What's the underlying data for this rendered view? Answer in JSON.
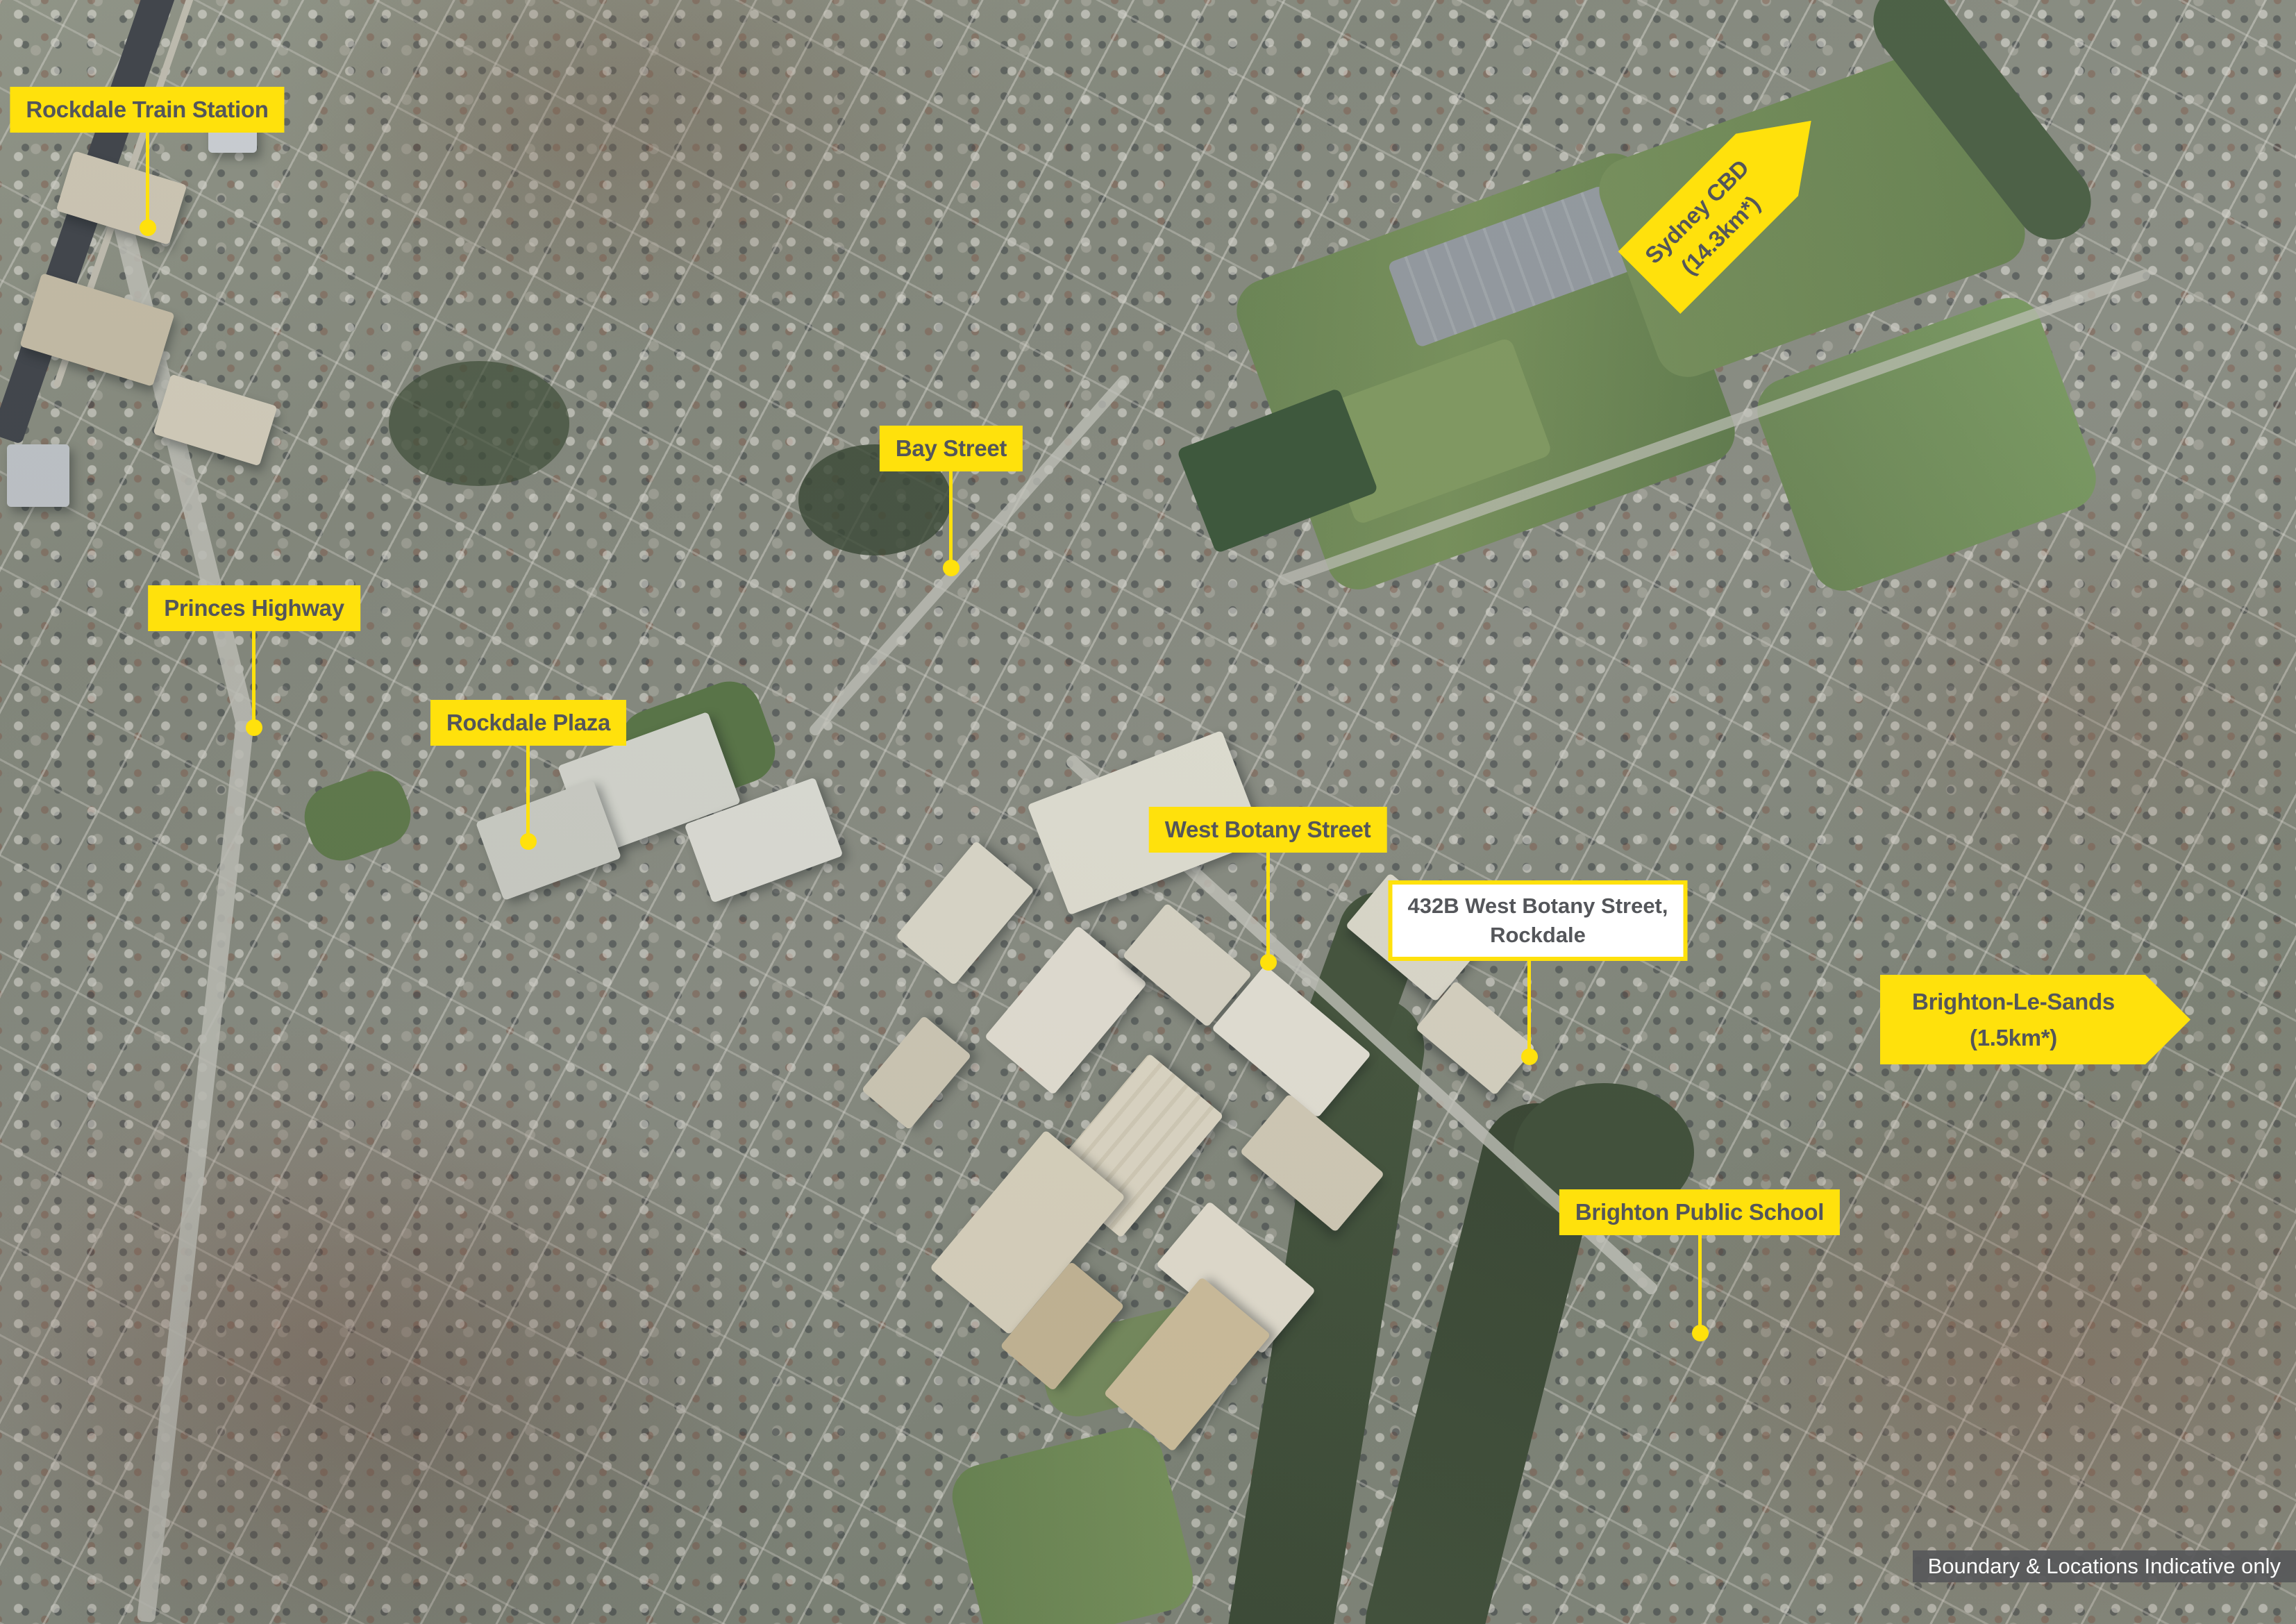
{
  "colors": {
    "label_yellow": "#FFE10C",
    "label_text": "#54565A",
    "site_box_bg": "#FFFFFF",
    "disclaimer_bg": "#58595B",
    "disclaimer_text": "#FFFFFF"
  },
  "labels": {
    "rockdale_station": {
      "text": "Rockdale Train Station"
    },
    "bay_street": {
      "text": "Bay Street"
    },
    "princes_highway": {
      "text": "Princes Highway"
    },
    "rockdale_plaza": {
      "text": "Rockdale Plaza"
    },
    "west_botany_street": {
      "text": "West Botany Street"
    },
    "brighton_public_school": {
      "text": "Brighton Public School"
    },
    "subject_site": {
      "line1": "432B West Botany Street,",
      "line2": "Rockdale"
    },
    "sydney_cbd": {
      "line1": "Sydney CBD",
      "line2": "(14.3km*)"
    },
    "brighton_le_sands": {
      "line1": "Brighton-Le-Sands",
      "line2": "(1.5km*)"
    }
  },
  "disclaimer": {
    "text": "Boundary & Locations Indicative only"
  }
}
